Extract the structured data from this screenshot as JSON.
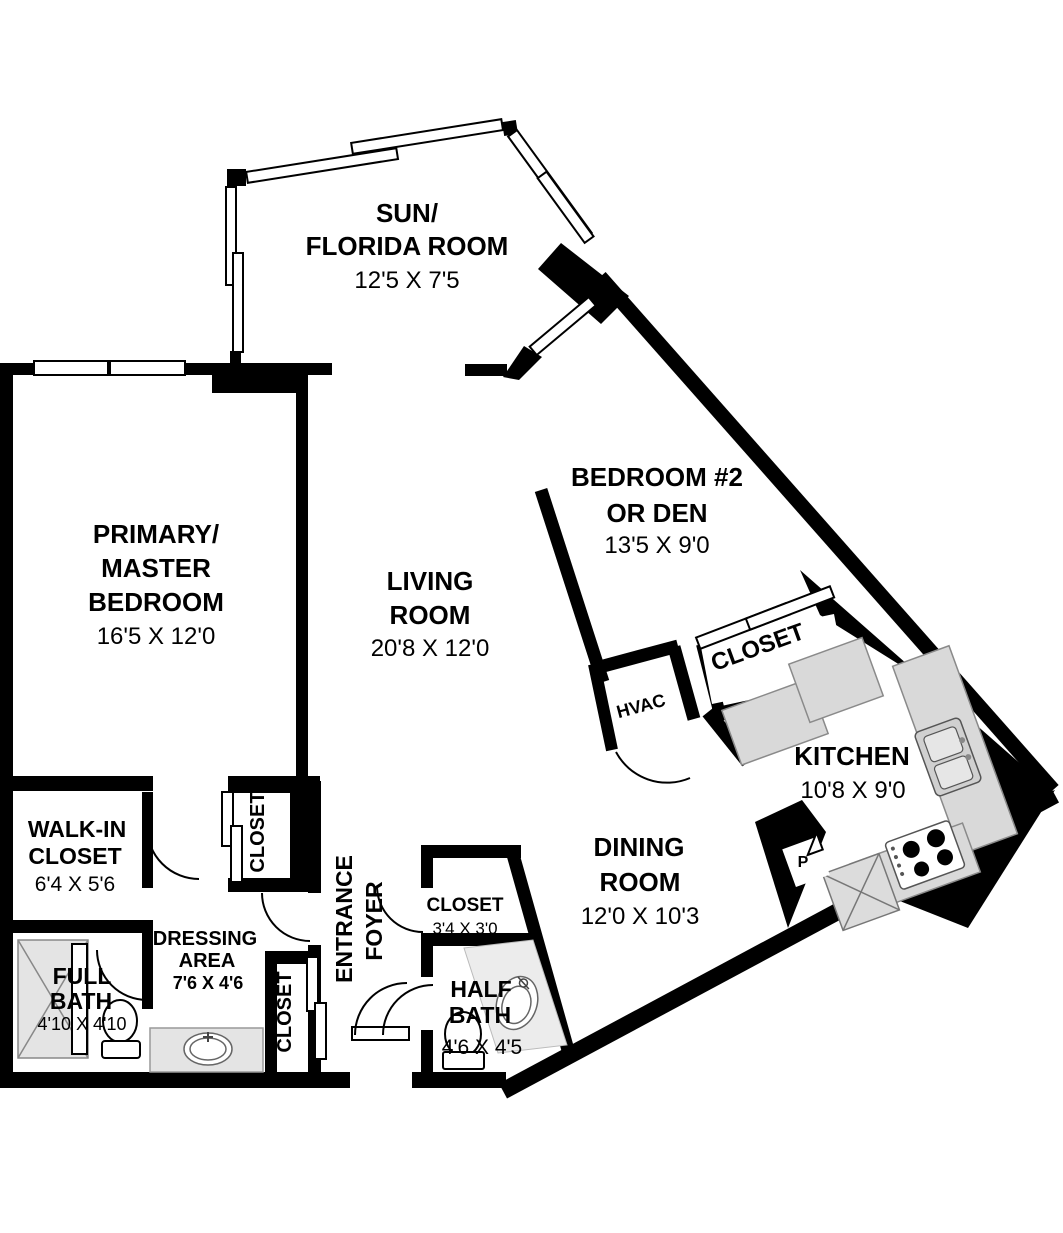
{
  "colors": {
    "wall": "#000000",
    "counter_fill": "#d9d9d9",
    "counter_stroke": "#8a8a8a",
    "shower_fill": "#e4e4e4",
    "bath_floor": "#ececec"
  },
  "rooms": {
    "sun_florida": {
      "name1": "SUN/",
      "name2": "FLORIDA ROOM",
      "dims": "12'5 X 7'5"
    },
    "master": {
      "name1": "PRIMARY/",
      "name2": "MASTER",
      "name3": "BEDROOM",
      "dims": "16'5 X 12'0"
    },
    "living": {
      "name1": "LIVING",
      "name2": "ROOM",
      "dims": "20'8 X 12'0"
    },
    "bedroom2": {
      "name1": "BEDROOM #2",
      "name2": "OR DEN",
      "dims": "13'5 X 9'0"
    },
    "bedroom2_closet": {
      "name": "CLOSET"
    },
    "hvac": {
      "name": "HVAC"
    },
    "kitchen": {
      "name": "KITCHEN",
      "dims": "10'8 X 9'0"
    },
    "dining": {
      "name1": "DINING",
      "name2": "ROOM",
      "dims": "12'0 X 10'3"
    },
    "walkin_closet": {
      "name1": "WALK-IN",
      "name2": "CLOSET",
      "dims": "6'4 X 5'6"
    },
    "full_bath": {
      "name1": "FULL",
      "name2": "BATH",
      "dims": "4'10 X 4'10"
    },
    "dressing": {
      "name1": "DRESSING",
      "name2": "AREA",
      "dims": "7'6 X 4'6"
    },
    "master_hall_closet": {
      "name": "CLOSET"
    },
    "entry_closet": {
      "name": "CLOSET"
    },
    "entrance_foyer": {
      "name1": "ENTRANCE",
      "name2": "FOYER"
    },
    "foyer_closet": {
      "name": "CLOSET",
      "dims": "3'4 X 3'0"
    },
    "half_bath": {
      "name1": "HALF",
      "name2": "BATH",
      "dims": "4'6 X 4'5"
    },
    "pantry": {
      "abbr": "P"
    }
  }
}
